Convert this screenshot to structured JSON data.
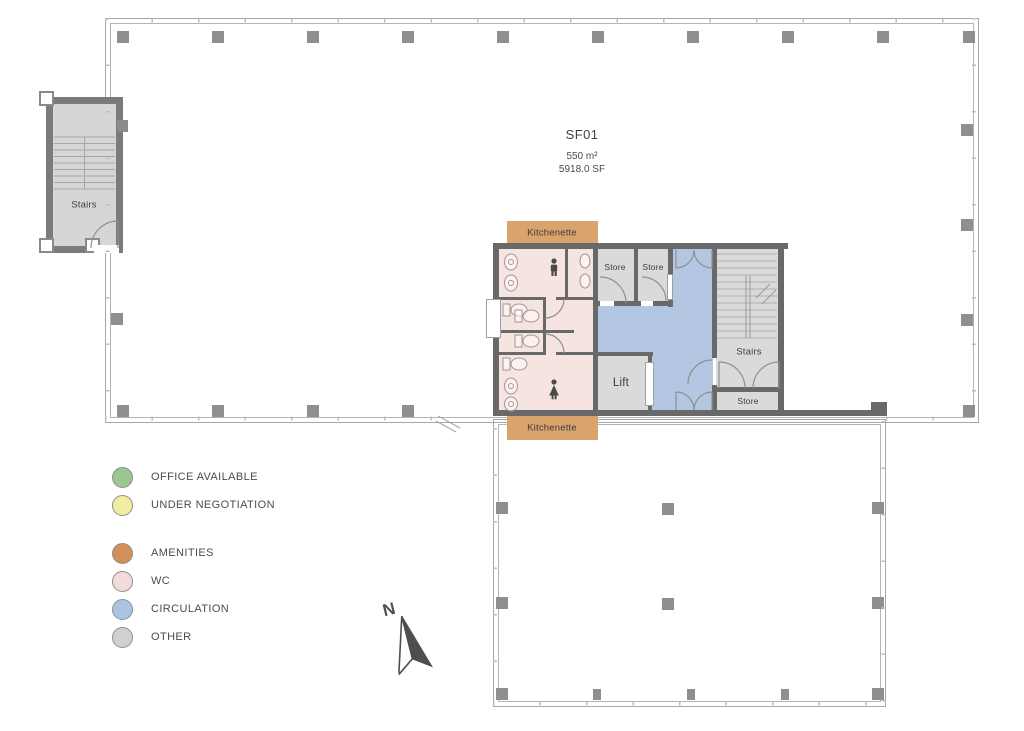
{
  "unit": {
    "id": "SF01",
    "area_metric": "550 m²",
    "area_imperial": "5918.0 SF"
  },
  "rooms": {
    "stairs_left": "Stairs",
    "kitchenette_top": "Kitchenette",
    "kitchenette_bottom": "Kitchenette",
    "store_1": "Store",
    "store_2": "Store",
    "store_3": "Store",
    "lift": "Lift",
    "stairs_core": "Stairs"
  },
  "legend": {
    "items": [
      {
        "label": "OFFICE AVAILABLE",
        "color": "#9bc693"
      },
      {
        "label": "UNDER NEGOTIATION",
        "color": "#f3eda1"
      },
      {
        "label": "AMENITIES",
        "color": "#d29058"
      },
      {
        "label": "WC",
        "color": "#f2dcda"
      },
      {
        "label": "CIRCULATION",
        "color": "#abc4e1"
      },
      {
        "label": "OTHER",
        "color": "#d0d0d0"
      }
    ]
  },
  "compass": {
    "label": "N"
  },
  "colors": {
    "wc": "#f6e4e1",
    "circulation": "#b4c7e2",
    "amenities": "#d9a36b",
    "other": "#dadada",
    "stair_floor": "#d7d6d4"
  }
}
